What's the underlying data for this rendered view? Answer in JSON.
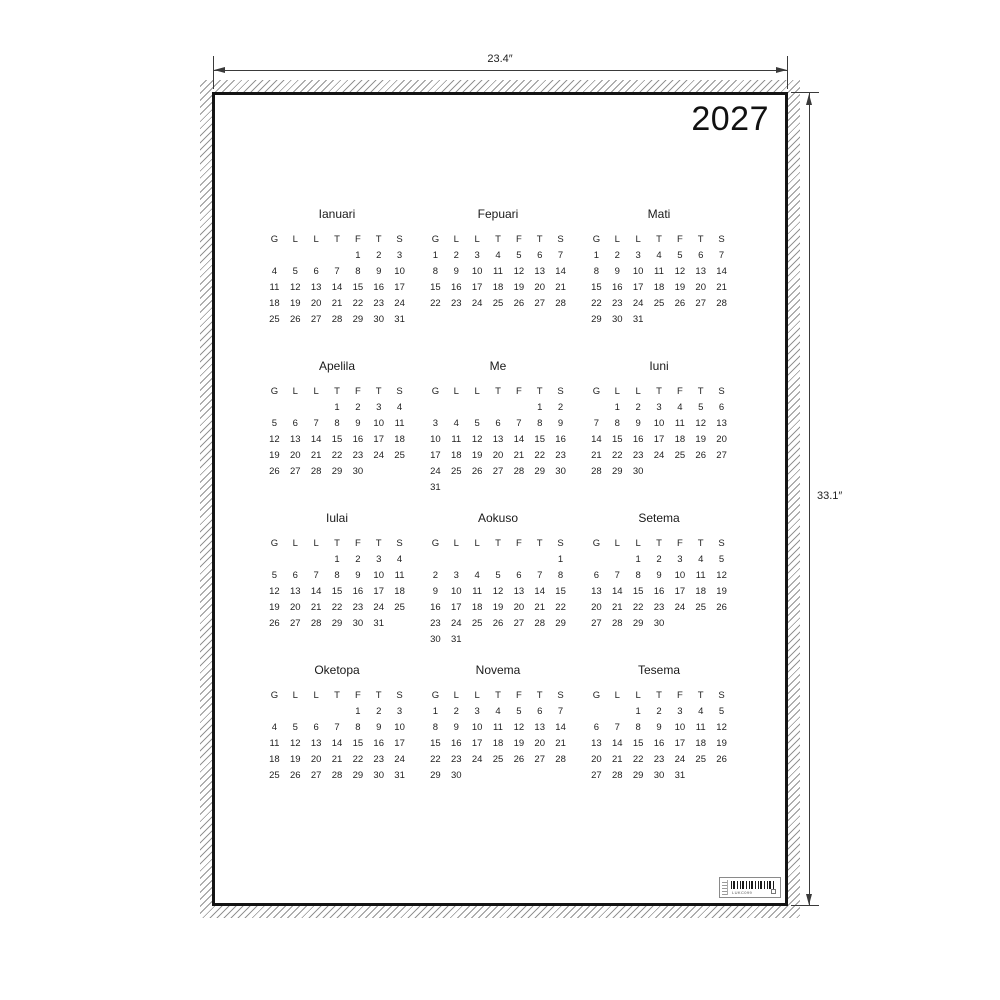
{
  "annotations": {
    "width_label": "23.4″",
    "height_label": "33.1″"
  },
  "poster": {
    "year": "2027",
    "day_headers": [
      "G",
      "L",
      "L",
      "T",
      "F",
      "T",
      "S"
    ],
    "months": [
      {
        "name": "Ianuari",
        "weeks": [
          [
            "",
            "",
            "",
            "",
            "1",
            "2",
            "3"
          ],
          [
            "4",
            "5",
            "6",
            "7",
            "8",
            "9",
            "10"
          ],
          [
            "11",
            "12",
            "13",
            "14",
            "15",
            "16",
            "17"
          ],
          [
            "18",
            "19",
            "20",
            "21",
            "22",
            "23",
            "24"
          ],
          [
            "25",
            "26",
            "27",
            "28",
            "29",
            "30",
            "31"
          ]
        ]
      },
      {
        "name": "Fepuari",
        "weeks": [
          [
            "1",
            "2",
            "3",
            "4",
            "5",
            "6",
            "7"
          ],
          [
            "8",
            "9",
            "10",
            "11",
            "12",
            "13",
            "14"
          ],
          [
            "15",
            "16",
            "17",
            "18",
            "19",
            "20",
            "21"
          ],
          [
            "22",
            "23",
            "24",
            "25",
            "26",
            "27",
            "28"
          ]
        ]
      },
      {
        "name": "Mati",
        "weeks": [
          [
            "1",
            "2",
            "3",
            "4",
            "5",
            "6",
            "7"
          ],
          [
            "8",
            "9",
            "10",
            "11",
            "12",
            "13",
            "14"
          ],
          [
            "15",
            "16",
            "17",
            "18",
            "19",
            "20",
            "21"
          ],
          [
            "22",
            "23",
            "24",
            "25",
            "26",
            "27",
            "28"
          ],
          [
            "29",
            "30",
            "31",
            "",
            "",
            "",
            ""
          ]
        ]
      },
      {
        "name": "Apelila",
        "weeks": [
          [
            "",
            "",
            "",
            "1",
            "2",
            "3",
            "4"
          ],
          [
            "5",
            "6",
            "7",
            "8",
            "9",
            "10",
            "11"
          ],
          [
            "12",
            "13",
            "14",
            "15",
            "16",
            "17",
            "18"
          ],
          [
            "19",
            "20",
            "21",
            "22",
            "23",
            "24",
            "25"
          ],
          [
            "26",
            "27",
            "28",
            "29",
            "30",
            "",
            ""
          ]
        ]
      },
      {
        "name": "Me",
        "weeks": [
          [
            "",
            "",
            "",
            "",
            "",
            "1",
            "2"
          ],
          [
            "3",
            "4",
            "5",
            "6",
            "7",
            "8",
            "9"
          ],
          [
            "10",
            "11",
            "12",
            "13",
            "14",
            "15",
            "16"
          ],
          [
            "17",
            "18",
            "19",
            "20",
            "21",
            "22",
            "23"
          ],
          [
            "24",
            "25",
            "26",
            "27",
            "28",
            "29",
            "30"
          ],
          [
            "31",
            "",
            "",
            "",
            "",
            "",
            ""
          ]
        ]
      },
      {
        "name": "Iuni",
        "weeks": [
          [
            "",
            "1",
            "2",
            "3",
            "4",
            "5",
            "6"
          ],
          [
            "7",
            "8",
            "9",
            "10",
            "11",
            "12",
            "13"
          ],
          [
            "14",
            "15",
            "16",
            "17",
            "18",
            "19",
            "20"
          ],
          [
            "21",
            "22",
            "23",
            "24",
            "25",
            "26",
            "27"
          ],
          [
            "28",
            "29",
            "30",
            "",
            "",
            "",
            ""
          ]
        ]
      },
      {
        "name": "Iulai",
        "weeks": [
          [
            "",
            "",
            "",
            "1",
            "2",
            "3",
            "4"
          ],
          [
            "5",
            "6",
            "7",
            "8",
            "9",
            "10",
            "11"
          ],
          [
            "12",
            "13",
            "14",
            "15",
            "16",
            "17",
            "18"
          ],
          [
            "19",
            "20",
            "21",
            "22",
            "23",
            "24",
            "25"
          ],
          [
            "26",
            "27",
            "28",
            "29",
            "30",
            "31",
            ""
          ]
        ]
      },
      {
        "name": "Aokuso",
        "weeks": [
          [
            "",
            "",
            "",
            "",
            "",
            "",
            "1"
          ],
          [
            "2",
            "3",
            "4",
            "5",
            "6",
            "7",
            "8"
          ],
          [
            "9",
            "10",
            "11",
            "12",
            "13",
            "14",
            "15"
          ],
          [
            "16",
            "17",
            "18",
            "19",
            "20",
            "21",
            "22"
          ],
          [
            "23",
            "24",
            "25",
            "26",
            "27",
            "28",
            "29"
          ],
          [
            "30",
            "31",
            "",
            "",
            "",
            "",
            ""
          ]
        ]
      },
      {
        "name": "Setema",
        "weeks": [
          [
            "",
            "",
            "1",
            "2",
            "3",
            "4",
            "5"
          ],
          [
            "6",
            "7",
            "8",
            "9",
            "10",
            "11",
            "12"
          ],
          [
            "13",
            "14",
            "15",
            "16",
            "17",
            "18",
            "19"
          ],
          [
            "20",
            "21",
            "22",
            "23",
            "24",
            "25",
            "26"
          ],
          [
            "27",
            "28",
            "29",
            "30",
            "",
            "",
            ""
          ]
        ]
      },
      {
        "name": "Oketopa",
        "weeks": [
          [
            "",
            "",
            "",
            "",
            "1",
            "2",
            "3"
          ],
          [
            "4",
            "5",
            "6",
            "7",
            "8",
            "9",
            "10"
          ],
          [
            "11",
            "12",
            "13",
            "14",
            "15",
            "16",
            "17"
          ],
          [
            "18",
            "19",
            "20",
            "21",
            "22",
            "23",
            "24"
          ],
          [
            "25",
            "26",
            "27",
            "28",
            "29",
            "30",
            "31"
          ]
        ]
      },
      {
        "name": "Novema",
        "weeks": [
          [
            "1",
            "2",
            "3",
            "4",
            "5",
            "6",
            "7"
          ],
          [
            "8",
            "9",
            "10",
            "11",
            "12",
            "13",
            "14"
          ],
          [
            "15",
            "16",
            "17",
            "18",
            "19",
            "20",
            "21"
          ],
          [
            "22",
            "23",
            "24",
            "25",
            "26",
            "27",
            "28"
          ],
          [
            "29",
            "30",
            "",
            "",
            "",
            "",
            ""
          ]
        ]
      },
      {
        "name": "Tesema",
        "weeks": [
          [
            "",
            "",
            "1",
            "2",
            "3",
            "4",
            "5"
          ],
          [
            "6",
            "7",
            "8",
            "9",
            "10",
            "11",
            "12"
          ],
          [
            "13",
            "14",
            "15",
            "16",
            "17",
            "18",
            "19"
          ],
          [
            "20",
            "21",
            "22",
            "23",
            "24",
            "25",
            "26"
          ],
          [
            "27",
            "28",
            "29",
            "30",
            "31",
            "",
            ""
          ]
        ]
      }
    ],
    "barcode": {
      "code_text": "LUKC099"
    }
  }
}
